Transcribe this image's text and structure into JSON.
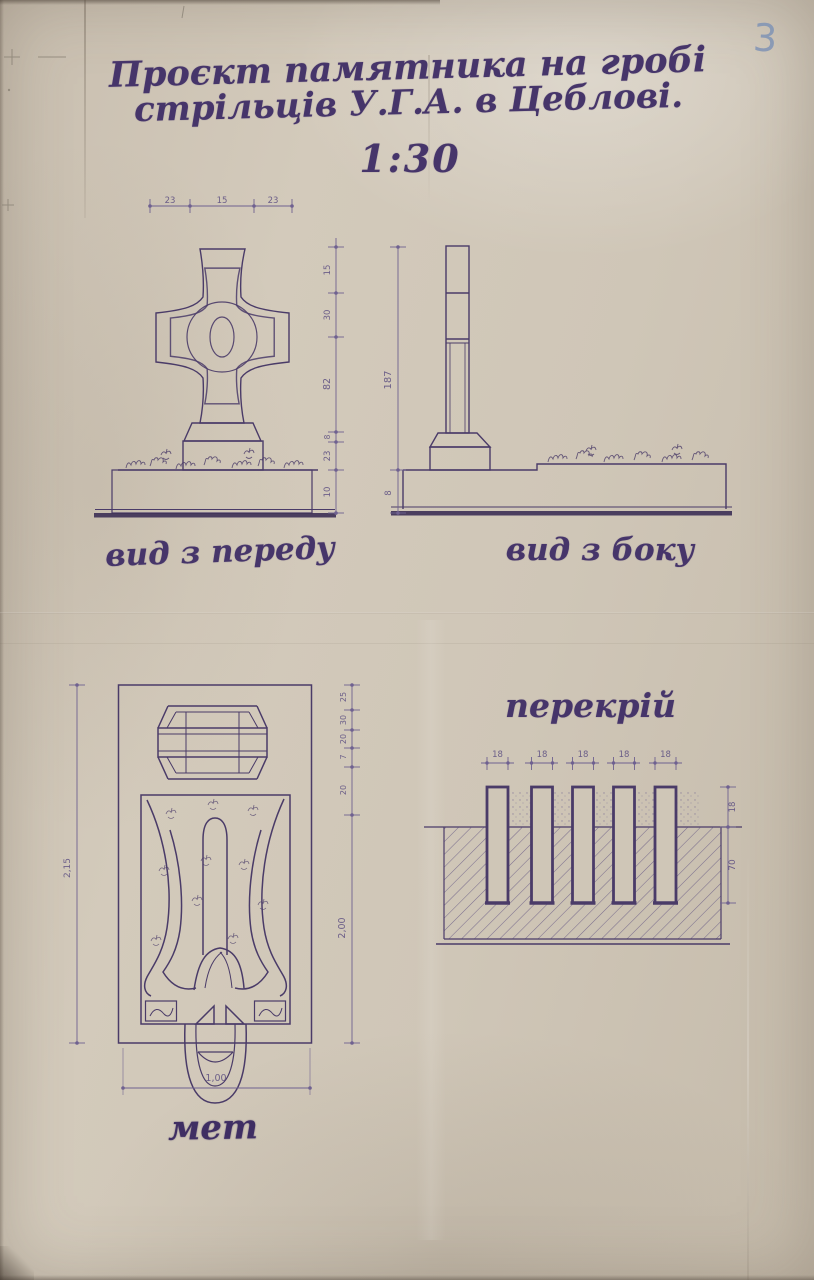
{
  "page": {
    "number": "3",
    "colors": {
      "ink": "#4a3b68",
      "paper": "#cfc6b7",
      "pencil_blue": "#8496b5"
    }
  },
  "title": {
    "line1": "Проєкт памятника на гробі",
    "line2": "стрільців У.Г.А. в Цеблові.",
    "scale": "1:30"
  },
  "front_view": {
    "label": "вид з переду",
    "top_dims": [
      "23",
      "15",
      "23"
    ],
    "side_dims": [
      "15",
      "30",
      "82",
      "8",
      "23",
      "10"
    ]
  },
  "side_view": {
    "label": "вид з боку",
    "height_dim": "187",
    "base_dim": "8"
  },
  "plan_view": {
    "label": "мет",
    "left_dim": "2,15",
    "right_dims": [
      "25",
      "30",
      "20",
      "7",
      "20"
    ],
    "right_main_dim": "2,00",
    "bottom_dim": "1,00"
  },
  "section_view": {
    "label": "перекрій",
    "pile_width_dims": [
      "18",
      "18",
      "18",
      "18",
      "18"
    ],
    "above_ground_dim": "18",
    "depth_dim": "70"
  }
}
